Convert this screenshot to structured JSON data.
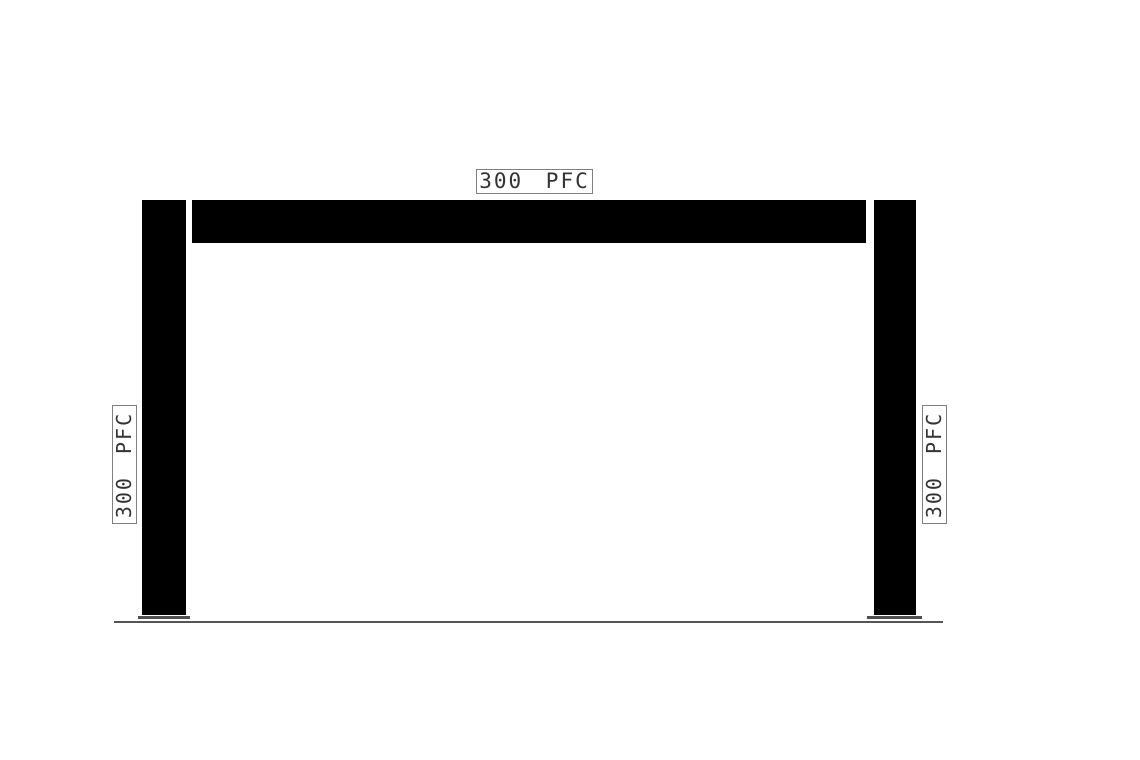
{
  "drawing": {
    "labels": {
      "beam": "300 PFC",
      "left_column": "300 PFC",
      "right_column": "300 PFC"
    },
    "colors": {
      "member_fill": "#000000",
      "label_border": "#808080",
      "label_text": "#333333",
      "base_plate": "#4f4f4f",
      "ground_line": "#555555",
      "background": "#ffffff"
    }
  }
}
